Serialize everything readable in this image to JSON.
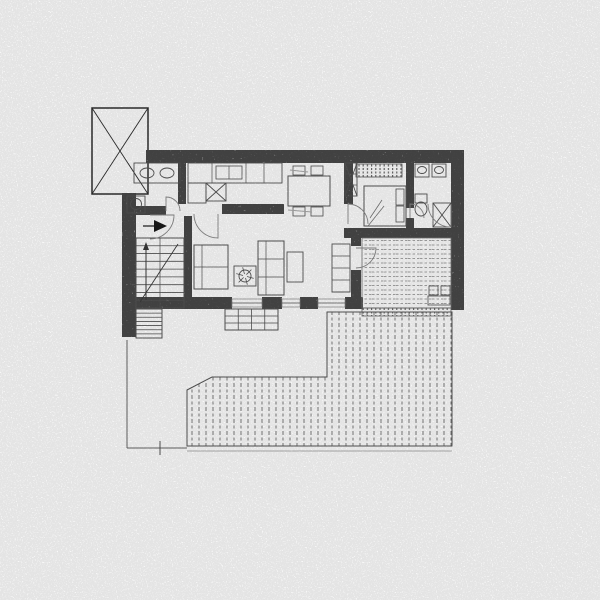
{
  "document": {
    "kind": "scanned-floor-plan",
    "canvas": {
      "width": 600,
      "height": 600,
      "background": "#ffffff"
    },
    "colors": {
      "paper": "#ffffff",
      "wall_fill": "#a3a3a3",
      "wall_speckle": "#1c1c1c",
      "line_dark": "#3a3a3a",
      "line_mid": "#555555",
      "line_faint": "#8a8a8a",
      "arrow_fill": "#1a1a1a"
    }
  },
  "plan": {
    "elements": [
      {
        "k": "box",
        "n": "skylight-shaft",
        "x": 92,
        "y": 108,
        "w": 56,
        "h": 86,
        "s": 1.5,
        "col": "#2f2f2f",
        "cross": true
      },
      {
        "k": "wall",
        "n": "wall-top",
        "x": 146,
        "y": 150,
        "w": 318,
        "h": 13
      },
      {
        "k": "wall",
        "n": "wall-right",
        "x": 451,
        "y": 150,
        "w": 13,
        "h": 160
      },
      {
        "k": "wall",
        "n": "wall-left",
        "x": 122,
        "y": 193,
        "w": 14,
        "h": 144
      },
      {
        "k": "wall",
        "n": "wall-bottom-a",
        "x": 122,
        "y": 297,
        "w": 110,
        "h": 12
      },
      {
        "k": "wall",
        "n": "wall-bottom-pier-b",
        "x": 262,
        "y": 297,
        "w": 20,
        "h": 12
      },
      {
        "k": "wall",
        "n": "wall-bottom-pier-c",
        "x": 300,
        "y": 297,
        "w": 18,
        "h": 12
      },
      {
        "k": "wall",
        "n": "wall-bottom-pier-d",
        "x": 345,
        "y": 297,
        "w": 18,
        "h": 12
      },
      {
        "k": "wall",
        "n": "wall-bedroom-south",
        "x": 344,
        "y": 228,
        "w": 110,
        "h": 10
      },
      {
        "k": "wall",
        "n": "wall-living-east",
        "x": 344,
        "y": 162,
        "w": 9,
        "h": 42
      },
      {
        "k": "wall",
        "n": "wall-terrace-west-a",
        "x": 351,
        "y": 228,
        "w": 10,
        "h": 18
      },
      {
        "k": "wall",
        "n": "wall-terrace-west-b",
        "x": 351,
        "y": 270,
        "w": 10,
        "h": 39
      },
      {
        "k": "wall",
        "n": "wall-bathroom-east",
        "x": 178,
        "y": 162,
        "w": 8,
        "h": 42
      },
      {
        "k": "wall",
        "n": "wall-entry",
        "x": 126,
        "y": 206,
        "w": 40,
        "h": 9
      },
      {
        "k": "wall",
        "n": "wall-kitchen-peninsula",
        "x": 222,
        "y": 204,
        "w": 62,
        "h": 10
      },
      {
        "k": "wall",
        "n": "wall-stair-east",
        "x": 184,
        "y": 216,
        "w": 8,
        "h": 92
      },
      {
        "k": "wall",
        "n": "wall-ensuite-west-a",
        "x": 406,
        "y": 162,
        "w": 8,
        "h": 46
      },
      {
        "k": "wall",
        "n": "wall-ensuite-west-b",
        "x": 406,
        "y": 218,
        "w": 8,
        "h": 10
      },
      {
        "k": "win",
        "n": "window-living-a",
        "x": 232,
        "y": 299,
        "w": 30,
        "h": 8
      },
      {
        "k": "win",
        "n": "window-living-b",
        "x": 282,
        "y": 299,
        "w": 18,
        "h": 8
      },
      {
        "k": "win",
        "n": "window-living-c",
        "x": 318,
        "y": 299,
        "w": 27,
        "h": 8
      },
      {
        "k": "poly",
        "n": "lower-deck-planking",
        "pts": [
          [
            187,
            390
          ],
          [
            212,
            377
          ],
          [
            327,
            377
          ],
          [
            327,
            312
          ],
          [
            452,
            312
          ],
          [
            452,
            446
          ],
          [
            187,
            446
          ]
        ],
        "fill": "planksV",
        "s": 1,
        "col": "#555555"
      },
      {
        "k": "box",
        "n": "upper-terrace-planking",
        "x": 362,
        "y": 238,
        "w": 89,
        "h": 70,
        "s": 0.8,
        "col": "#777777",
        "fill": "planksH"
      },
      {
        "k": "box",
        "n": "terrace-railing",
        "x": 362,
        "y": 308,
        "w": 89,
        "h": 8,
        "s": 0.8,
        "col": "#666666",
        "fill": "ticksV"
      },
      {
        "k": "ln",
        "n": "plot-boundary-west",
        "x1": 127,
        "y1": 340,
        "x2": 127,
        "y2": 448,
        "w": 1,
        "col": "#666666"
      },
      {
        "k": "ln",
        "n": "plot-boundary-south",
        "x1": 127,
        "y1": 448,
        "x2": 187,
        "y2": 448,
        "w": 1,
        "col": "#666666"
      },
      {
        "k": "ln",
        "n": "deck-south-edge",
        "x1": 187,
        "y1": 451,
        "x2": 452,
        "y2": 451,
        "w": 0.8,
        "col": "#9a9a9a"
      },
      {
        "k": "ln",
        "n": "survey-tick",
        "x1": 160,
        "y1": 441,
        "x2": 160,
        "y2": 455,
        "w": 1,
        "col": "#555555"
      },
      {
        "k": "stair",
        "n": "main-staircase",
        "x": 136,
        "y": 238,
        "w": 48,
        "h": 70,
        "steps": 9,
        "mid": true,
        "diag": true,
        "arrow": true
      },
      {
        "k": "stair",
        "n": "side-steps",
        "x": 136,
        "y": 309,
        "w": 26,
        "h": 29,
        "steps": 7
      },
      {
        "k": "grid",
        "n": "garden-steps",
        "x": 225,
        "y": 309,
        "w": 53,
        "h": 21,
        "cols": 4,
        "rows": 3
      },
      {
        "k": "box",
        "n": "bath-vanity",
        "x": 134,
        "y": 163,
        "w": 46,
        "h": 20,
        "s": 0.9
      },
      {
        "k": "ell",
        "n": "bath-basin-1",
        "cx": 147,
        "cy": 173,
        "rx": 7,
        "ry": 5
      },
      {
        "k": "ell",
        "n": "bath-basin-2",
        "cx": 167,
        "cy": 173,
        "rx": 7,
        "ry": 5
      },
      {
        "k": "box",
        "n": "washing-machine",
        "x": 127,
        "y": 196,
        "w": 18,
        "h": 17,
        "s": 0.9
      },
      {
        "k": "ell",
        "n": "washer-drum",
        "cx": 136,
        "cy": 204,
        "rx": 5.5,
        "ry": 5.5
      },
      {
        "k": "box",
        "n": "kitchen-counter",
        "x": 188,
        "y": 163,
        "w": 94,
        "h": 20,
        "s": 0.9,
        "divX": [
          212,
          246,
          264
        ]
      },
      {
        "k": "box",
        "n": "kitchen-sink",
        "x": 216,
        "y": 166,
        "w": 26,
        "h": 13,
        "s": 0.8,
        "divX": [
          229
        ]
      },
      {
        "k": "box",
        "n": "kitchen-hob",
        "x": 206,
        "y": 183,
        "w": 20,
        "h": 18,
        "s": 0.9,
        "cross": true
      },
      {
        "k": "box",
        "n": "kitchen-oven",
        "x": 188,
        "y": 183,
        "w": 18,
        "h": 20,
        "s": 0.9
      },
      {
        "k": "box",
        "n": "dining-table",
        "x": 288,
        "y": 176,
        "w": 42,
        "h": 30,
        "s": 1
      },
      {
        "k": "box",
        "n": "dining-chair-1",
        "x": 293,
        "y": 166,
        "w": 12,
        "h": 9,
        "s": 0.8
      },
      {
        "k": "box",
        "n": "dining-chair-2",
        "x": 311,
        "y": 166,
        "w": 12,
        "h": 9,
        "s": 0.8
      },
      {
        "k": "box",
        "n": "dining-chair-3",
        "x": 293,
        "y": 207,
        "w": 12,
        "h": 9,
        "s": 0.8
      },
      {
        "k": "box",
        "n": "dining-chair-4",
        "x": 311,
        "y": 207,
        "w": 12,
        "h": 9,
        "s": 0.8
      },
      {
        "k": "ln",
        "n": "pencil-smudge-a",
        "x1": 290,
        "y1": 170,
        "x2": 308,
        "y2": 172,
        "w": 1,
        "col": "#aaaaaa"
      },
      {
        "k": "ln",
        "n": "pencil-smudge-b",
        "x1": 288,
        "y1": 210,
        "x2": 312,
        "y2": 212,
        "w": 1,
        "col": "#aaaaaa"
      },
      {
        "k": "box",
        "n": "hall-wardrobe",
        "x": 345,
        "y": 163,
        "w": 12,
        "h": 33,
        "s": 0.9,
        "divY": [
          174,
          185
        ],
        "cross": true
      },
      {
        "k": "box",
        "n": "bedroom-closet",
        "x": 356,
        "y": 164,
        "w": 46,
        "h": 13,
        "s": 0.8,
        "fill": "ticksV"
      },
      {
        "k": "box",
        "n": "double-bed",
        "x": 364,
        "y": 186,
        "w": 42,
        "h": 40,
        "s": 1
      },
      {
        "k": "box",
        "n": "bed-pillow-1",
        "x": 396,
        "y": 189,
        "w": 8,
        "h": 16,
        "s": 0.8
      },
      {
        "k": "box",
        "n": "bed-pillow-2",
        "x": 396,
        "y": 206,
        "w": 8,
        "h": 16,
        "s": 0.8
      },
      {
        "k": "ln",
        "n": "blanket-fold-a",
        "x1": 370,
        "y1": 218,
        "x2": 382,
        "y2": 200,
        "w": 0.8,
        "col": "#777777"
      },
      {
        "k": "ln",
        "n": "blanket-fold-b",
        "x1": 368,
        "y1": 226,
        "x2": 384,
        "y2": 206,
        "w": 0.8,
        "col": "#777777"
      },
      {
        "k": "box",
        "n": "ensuite-sink-1",
        "x": 415,
        "y": 164,
        "w": 14,
        "h": 13,
        "s": 0.9
      },
      {
        "k": "ell",
        "n": "ensuite-basin-1",
        "cx": 422,
        "cy": 170,
        "rx": 4.5,
        "ry": 3.5
      },
      {
        "k": "box",
        "n": "ensuite-sink-2",
        "x": 432,
        "y": 164,
        "w": 14,
        "h": 13,
        "s": 0.9
      },
      {
        "k": "ell",
        "n": "ensuite-basin-2",
        "cx": 439,
        "cy": 170,
        "rx": 4.5,
        "ry": 3.5
      },
      {
        "k": "box",
        "n": "ensuite-toilet-tank",
        "x": 415,
        "y": 194,
        "w": 12,
        "h": 9,
        "s": 0.9
      },
      {
        "k": "ell",
        "n": "ensuite-toilet-bowl",
        "cx": 421,
        "cy": 209,
        "rx": 6,
        "ry": 7
      },
      {
        "k": "box",
        "n": "ensuite-shower",
        "x": 433,
        "y": 203,
        "w": 18,
        "h": 24,
        "s": 0.9,
        "cross": true
      },
      {
        "k": "box",
        "n": "sofa-left",
        "x": 194,
        "y": 245,
        "w": 34,
        "h": 44,
        "s": 1,
        "divX": [
          202
        ],
        "divY": [
          267
        ]
      },
      {
        "k": "box",
        "n": "sofa-right",
        "x": 258,
        "y": 241,
        "w": 26,
        "h": 54,
        "s": 1,
        "divX": [
          266
        ],
        "divY": [
          259,
          277
        ]
      },
      {
        "k": "box",
        "n": "coffee-table",
        "x": 234,
        "y": 266,
        "w": 22,
        "h": 20,
        "s": 0.9
      },
      {
        "k": "plant",
        "n": "potted-plant",
        "cx": 245,
        "cy": 276,
        "r": 6
      },
      {
        "k": "box",
        "n": "side-table",
        "x": 287,
        "y": 252,
        "w": 16,
        "h": 30,
        "s": 0.9
      },
      {
        "k": "box",
        "n": "wall-shelf",
        "x": 332,
        "y": 244,
        "w": 18,
        "h": 48,
        "s": 0.9,
        "divY": [
          256,
          268,
          280,
          292
        ]
      },
      {
        "k": "box",
        "n": "bistro-chair-1",
        "x": 429,
        "y": 286,
        "w": 9,
        "h": 9,
        "s": 0.8
      },
      {
        "k": "box",
        "n": "bistro-chair-2",
        "x": 441,
        "y": 286,
        "w": 9,
        "h": 9,
        "s": 0.8
      },
      {
        "k": "box",
        "n": "bistro-table",
        "x": 428,
        "y": 296,
        "w": 22,
        "h": 9,
        "s": 0.8
      },
      {
        "k": "door",
        "n": "bathroom-door-swing",
        "cx": 166,
        "cy": 211,
        "r": 14,
        "a1": 270,
        "a2": 360
      },
      {
        "k": "door",
        "n": "entry-door-swing",
        "cx": 150,
        "cy": 215,
        "r": 24,
        "a1": 0,
        "a2": 90
      },
      {
        "k": "door",
        "n": "hall-door-swing",
        "cx": 218,
        "cy": 214,
        "r": 24,
        "a1": 90,
        "a2": 180
      },
      {
        "k": "door",
        "n": "bedroom-door-swing",
        "cx": 348,
        "cy": 224,
        "r": 20,
        "a1": 270,
        "a2": 360
      },
      {
        "k": "door",
        "n": "ensuite-door-swing",
        "cx": 410,
        "cy": 218,
        "r": 14,
        "a1": 270,
        "a2": 360
      },
      {
        "k": "door",
        "n": "shower-door-swing",
        "cx": 451,
        "cy": 204,
        "r": 23,
        "a1": 90,
        "a2": 180
      },
      {
        "k": "door",
        "n": "terrace-door-swing",
        "cx": 356,
        "cy": 248,
        "r": 20,
        "a1": 0,
        "a2": 90
      },
      {
        "k": "tri",
        "n": "entry-direction-arrow",
        "pts": [
          [
            154,
            220
          ],
          [
            154,
            232
          ],
          [
            167,
            226
          ]
        ]
      },
      {
        "k": "ln",
        "n": "entry-arrow-stem",
        "x1": 143,
        "y1": 226,
        "x2": 154,
        "y2": 226,
        "w": 1.2,
        "col": "#1a1a1a"
      }
    ]
  }
}
